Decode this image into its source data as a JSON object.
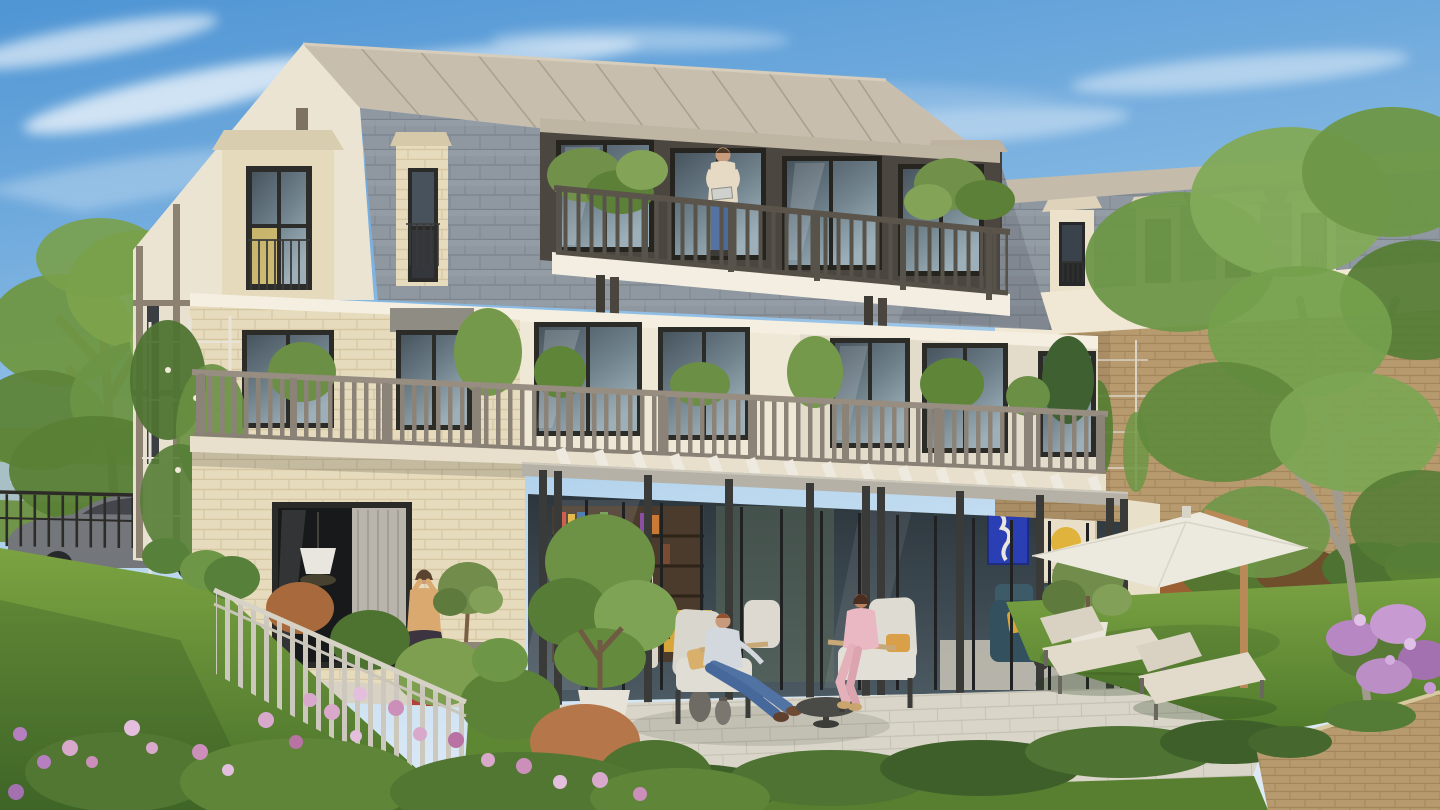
{
  "meta": {
    "kind": "architectural exterior rendering",
    "subject": "Three-storey residence with mansard roof, terraces and landscaped rear garden",
    "render_size": "1440x810",
    "lighting": "low warm sun from the left, clear blue sky with wispy clouds"
  },
  "palette": {
    "sky_top": "#4F95D4",
    "sky_horizon": "#DDEAF6",
    "zinc_roof": "#C8BEAD",
    "slate_roof": "#8F97A1",
    "stucco": "#F0E8D6",
    "brick_cream": "#E7DBBD",
    "brick_tan": "#B79A6E",
    "dark_frames": "#2B2B28",
    "penthouse_wall": "#4B4740",
    "railing_dark": "#57534B",
    "railing_grey": "#8C8378",
    "pergola_post": "#3A3A38",
    "terrace_tile": "#D9D5C8",
    "lawn": "#6F9A3E",
    "foliage": "#6D9246",
    "umbrella": "#ECEADF",
    "water": "#A9BFC6",
    "flowers_pink": "#D9A9CC",
    "flowers_purple": "#B687C2"
  },
  "building": {
    "storeys": 3,
    "roof": {
      "type": "mansard",
      "upper_material": "zinc standing seam",
      "lower_material": "slate shingles",
      "dormers": [
        {
          "position": "left",
          "style": "stone surround, iron juliet balcony, yellow interior"
        },
        {
          "position": "centre-left",
          "style": "narrow brick hatch with dark door"
        },
        {
          "position": "right",
          "style": "glazed dormer with planted balcony"
        }
      ]
    },
    "penthouse": {
      "facade": "dark bronze cladding",
      "window_bays": 4,
      "balcony": {
        "railing": "dark timber balusters",
        "plants": "potted shrubs both ends"
      }
    },
    "middle_floor": {
      "facade_left": "cream brick",
      "facade_centre": "white stucco",
      "window_bays": 7,
      "terrace": {
        "railing": "grey timber balusters",
        "planting": "shrubs, small trees, climbing trellis"
      }
    },
    "ground_floor": {
      "left_wing": "cream brick with large dark glazed bay, pendant lamp and curtain inside",
      "pergola": {
        "posts": 11,
        "post_colour": "#3A3A38",
        "slats": "white timber on pale beam"
      },
      "interior_visible": [
        "bookshelf wall with colourful books",
        "yellow sideboard",
        "dining chairs",
        "navy sofa with yellow cushion",
        "two framed posters",
        "indoor plant"
      ]
    }
  },
  "interior_art": {
    "poster_blue": {
      "label": "blue cut-out artwork",
      "background": "#2B3FB5"
    },
    "poster_beige": {
      "title": "MATISSE",
      "motif": "yellow sun with dark line drawing",
      "background": "#E9DFC9"
    }
  },
  "people": [
    {
      "id": "balcony-man",
      "where": "penthouse balcony",
      "activity": "reading a tablet",
      "clothing": "beige sweater, blue jeans"
    },
    {
      "id": "standing-woman",
      "where": "lower terrace by glazed bay",
      "activity": "standing, hands to hair",
      "clothing": "camel sweater, dark floral skirt, red shoes"
    },
    {
      "id": "seated-man",
      "where": "garden terrace armchair",
      "clothing": "light shirt, blue jeans, brown shoes"
    },
    {
      "id": "seated-woman",
      "where": "garden terrace armchair",
      "clothing": "pink suit"
    }
  ],
  "garden": {
    "furniture": [
      {
        "item": "lounge armchairs with pale cushions",
        "count": 2
      },
      {
        "item": "round coffee table",
        "count": 1
      },
      {
        "item": "sun loungers",
        "count": 2
      },
      {
        "item": "cantilever parasol, wooden mast",
        "count": 1
      },
      {
        "item": "metal lanterns",
        "count": 2
      },
      {
        "item": "white potted trees",
        "count": 3
      },
      {
        "item": "dark vases",
        "count": 2
      }
    ],
    "landscape": [
      "lawn",
      "mixed green and copper shrub hedge",
      "grey picket fence",
      "pink flowering border",
      "purple flowers over wall",
      "ivy groundcover",
      "tan brick retaining wall"
    ]
  },
  "surroundings": {
    "left": [
      "mature tree",
      "river bank and water",
      "black metal fence",
      "parked grey car",
      "red brick kerb wall"
    ],
    "right": [
      "neighbour building with 4 slate dormers over tan brick wall",
      "planted trellis",
      "large tree"
    ]
  }
}
